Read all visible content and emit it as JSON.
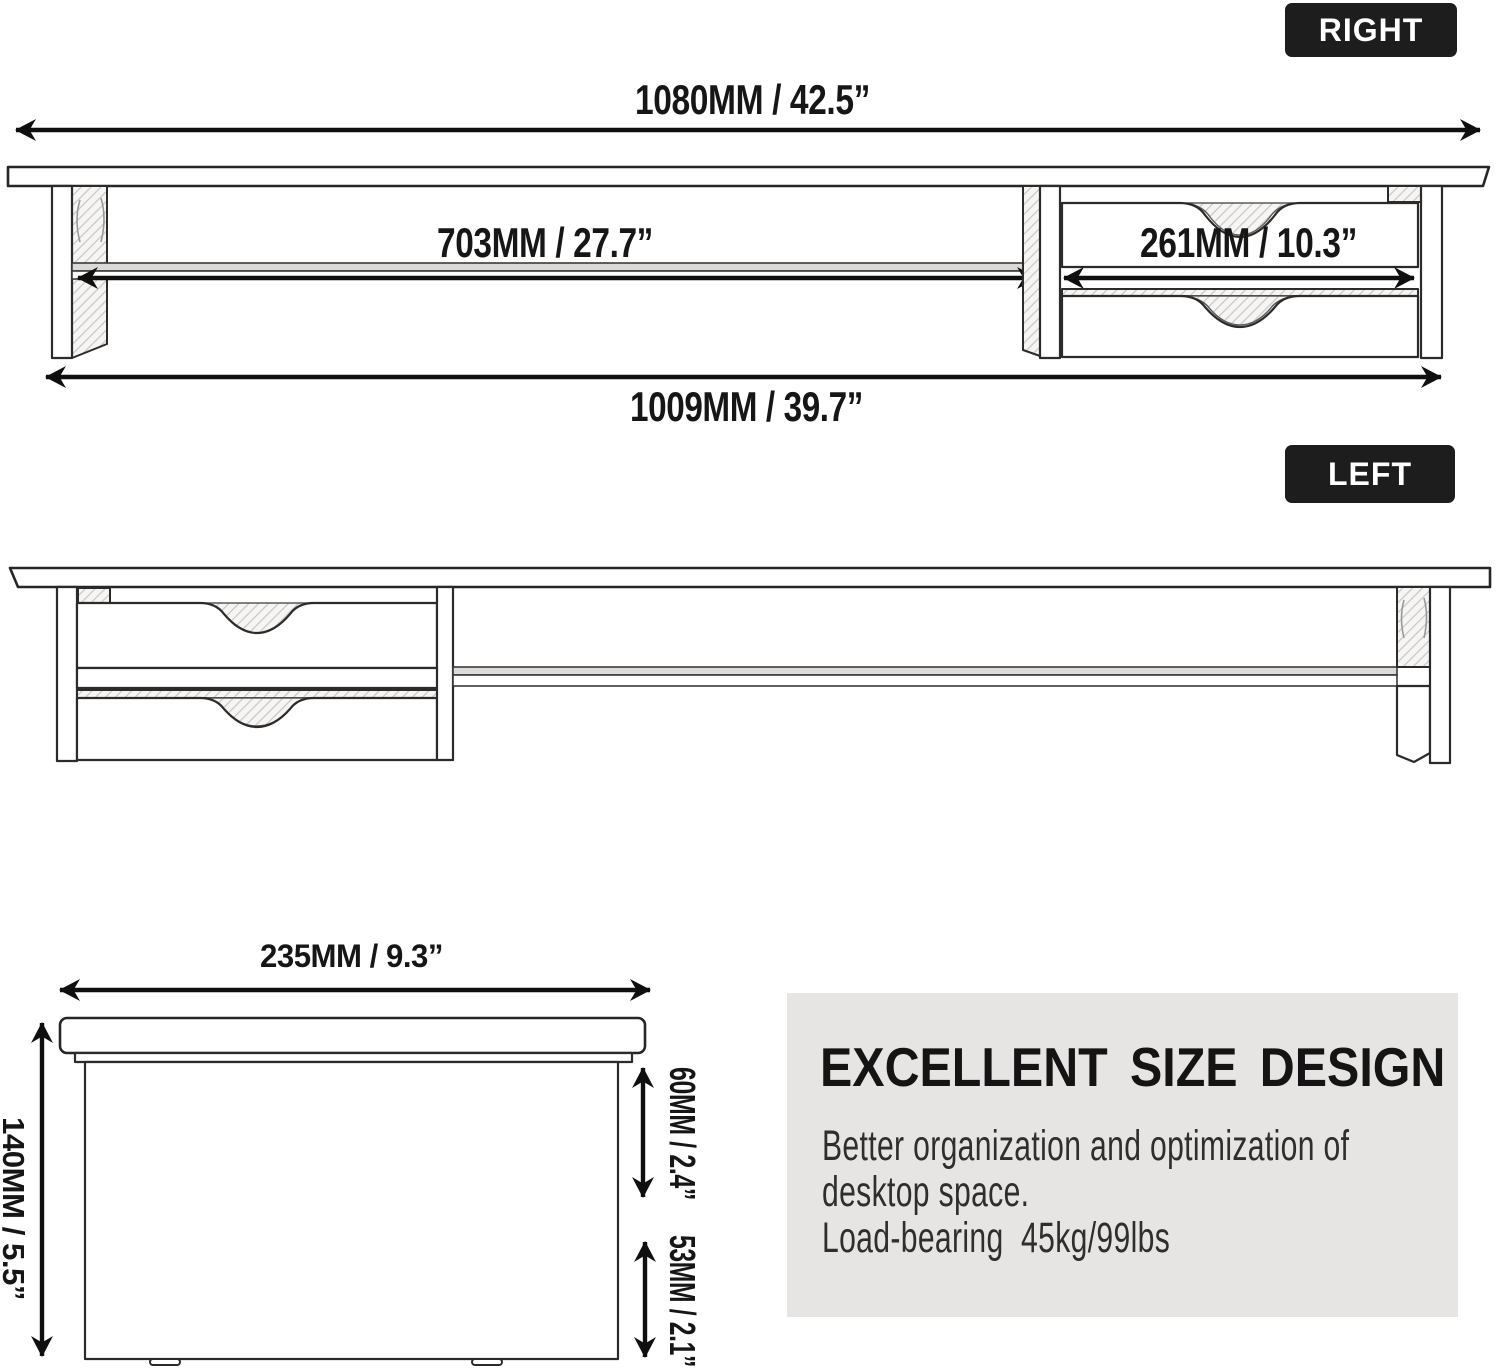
{
  "badges": {
    "right": "RIGHT",
    "left": "LEFT"
  },
  "top_view": {
    "dim_overall_width": "1080MM / 42.5”",
    "dim_shelf_width": "703MM / 27.7”",
    "dim_drawer_width": "261MM / 10.3”",
    "dim_base_width": "1009MM / 39.7”"
  },
  "side_view": {
    "dim_depth": "235MM / 9.3”",
    "dim_height": "140MM / 5.5”",
    "dim_clearance": "60MM / 2.4”",
    "dim_drawer_height": "53MM / 2.1”"
  },
  "info_panel": {
    "heading": "EXCELLENT SIZE DESIGN",
    "lines": [
      "Better organization and optimization of",
      "desktop space.",
      "Load-bearing  45kg/99lbs"
    ]
  },
  "colors": {
    "badge_bg": "#1d1d1d",
    "panel_bg": "#e6e5e4",
    "ink": "#161616",
    "line_work": "#2b2b2b"
  }
}
